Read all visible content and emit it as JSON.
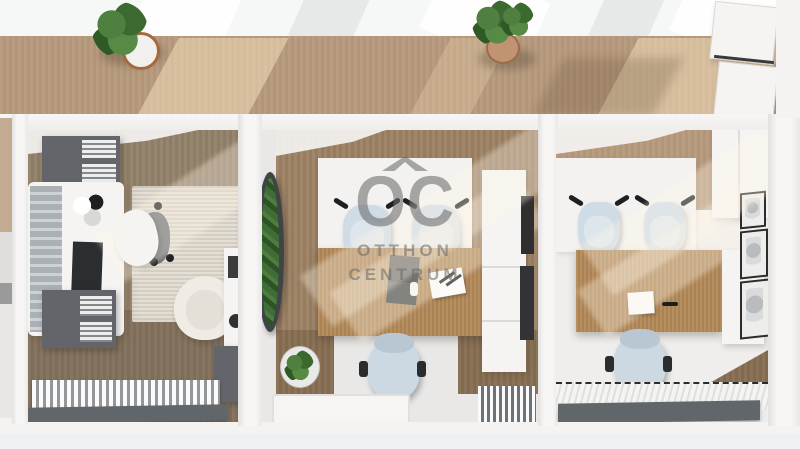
{
  "watermark": {
    "logo": "OC",
    "line1": "OTTHON",
    "line2": "CENTRUM"
  },
  "palette": {
    "corridor_wood": "#b79b7e",
    "room_floor_wood": "#94826d",
    "desk_wood": "#b08859",
    "wall_white": "#f4f3f2",
    "chair_blue": "#cfdbe5",
    "cabinet_grey": "#63656a",
    "slab_grey": "#61666b",
    "rug_beige": "#dbd4c7",
    "plant_green": "#4a7a3c",
    "sunlight": "#f3ddb9",
    "watermark_grey": "#6a6a6a"
  },
  "scene": {
    "type": "3d-top-down-office-render",
    "corridor_items": [
      "potted-plant",
      "potted-plant",
      "glass-cabinets"
    ],
    "rooms": [
      {
        "name": "left-office",
        "items": [
          "grey-shelves-with-binders",
          "white-desk-with-monitor",
          "office-chair-with-throw",
          "beige-rug",
          "cream-armchair",
          "printer-stand",
          "grey-cabinet",
          "radiator-mat"
        ]
      },
      {
        "name": "middle-office",
        "items": [
          "vertical-garden-oval",
          "white-back-panel",
          "two-guest-chairs",
          "wooden-desk",
          "laptop",
          "papers",
          "office-chair",
          "round-plant",
          "white-cabinet-column",
          "wall-frames",
          "striped-mat",
          "white-floor-mat"
        ]
      },
      {
        "name": "right-office",
        "items": [
          "white-back-panel",
          "two-guest-chairs",
          "white-wardrobe",
          "wooden-desk",
          "paper-sheet",
          "office-chair",
          "three-wall-frames",
          "ribbed-floor-mat"
        ]
      }
    ]
  }
}
